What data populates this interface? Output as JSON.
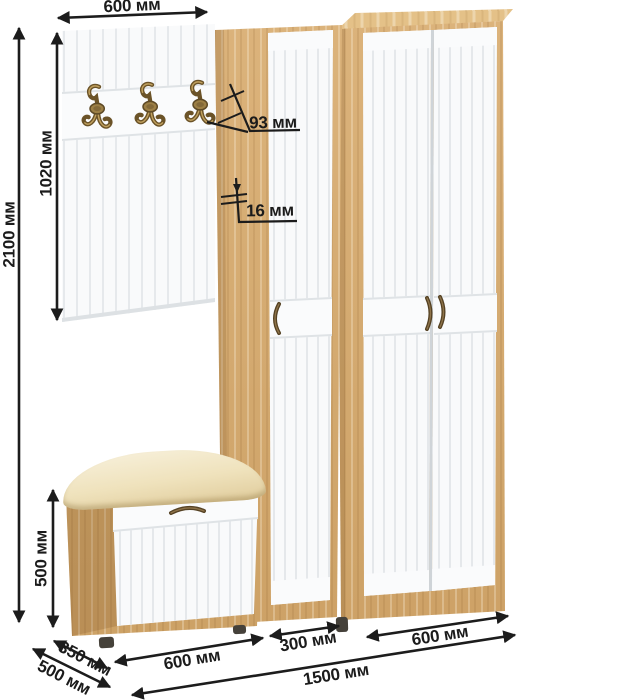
{
  "dimensions": {
    "top_width": "600 мм",
    "panel_height": "1020 мм",
    "total_height": "2100 мм",
    "edge_width": "93 мм",
    "panel_thickness": "16 мм",
    "bench_height": "500 мм",
    "bench_depth": "350 мм",
    "cabinet_depth": "500 мм",
    "bench_width": "600 мм",
    "narrow_width": "300 мм",
    "wide_width": "600 мм",
    "total_width": "1500 мм"
  },
  "furniture": {
    "pieces": [
      "coat-panel",
      "narrow-wardrobe",
      "wide-wardrobe",
      "shoe-bench"
    ],
    "hook_count": 3,
    "colors": {
      "oak": "#d8ab6d",
      "oak_top": "#e4c188",
      "door_white": "#f9fafb",
      "groove": "#e6e9ec",
      "cushion": "#efe2bc",
      "dimension_ink": "#1c1c1c",
      "brass_hook": "#8a6f3a",
      "handle_bronze": "#554224"
    }
  }
}
